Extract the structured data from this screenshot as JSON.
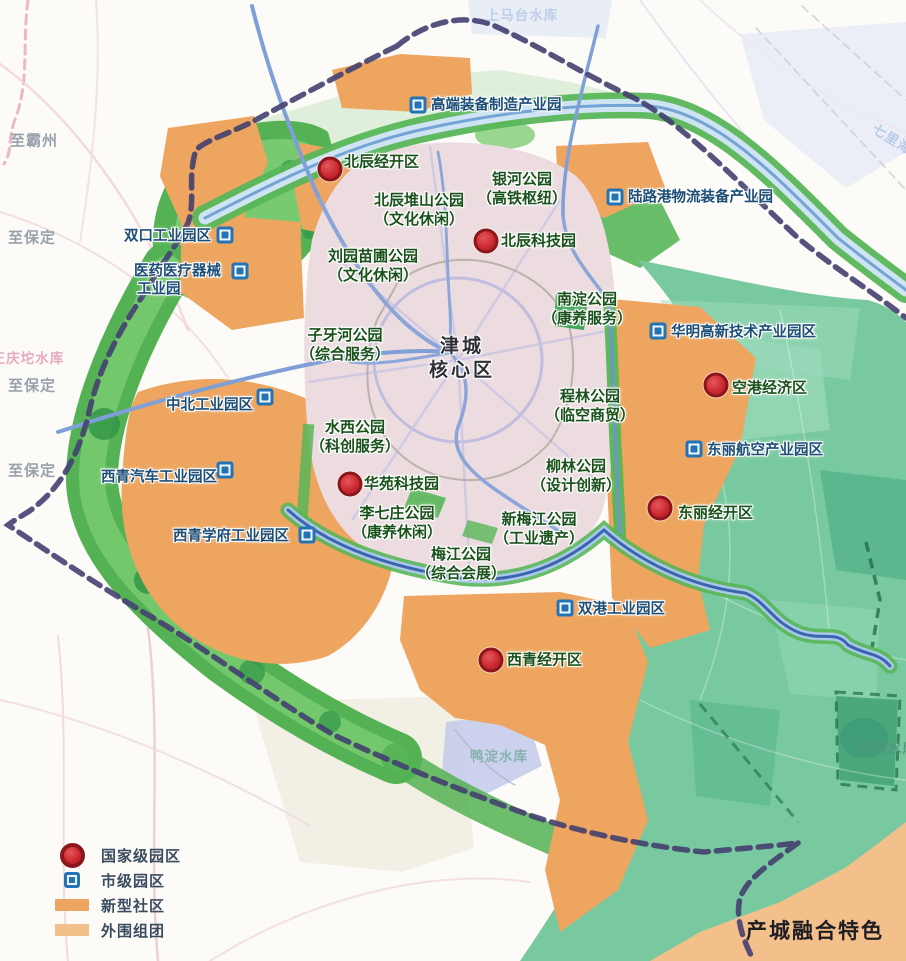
{
  "core_label": {
    "line1": "津城",
    "line2": "核心区",
    "x": 462,
    "y": 359
  },
  "corner_note": {
    "text": "产城融合特色",
    "x": 815,
    "y": 930
  },
  "direction_labels": [
    {
      "text": "至霸州",
      "x": 10,
      "y": 140
    },
    {
      "text": "至保定",
      "x": 8,
      "y": 237
    },
    {
      "text": "至保定",
      "x": 8,
      "y": 385
    },
    {
      "text": "至保定",
      "x": 8,
      "y": 470
    }
  ],
  "water_labels": [
    {
      "text": "上马台水库",
      "x": 522,
      "y": 14,
      "color": "#b9cbe8",
      "rotate": 0
    },
    {
      "text": "七里海",
      "x": 893,
      "y": 138,
      "color": "#b3c8e8",
      "rotate": 32
    },
    {
      "text": "王庆坨水库",
      "x": 28,
      "y": 357,
      "color": "#e4a2b8",
      "rotate": 0
    },
    {
      "text": "鸭淀水库",
      "x": 499,
      "y": 755,
      "color": "#7fb0a8",
      "rotate": 0
    },
    {
      "text": "官港水库",
      "x": 888,
      "y": 747,
      "color": "#4f9880",
      "rotate": 0
    }
  ],
  "park_labels": [
    {
      "line1": "北辰堆山公园",
      "line2": "（文化休闲）",
      "x": 419,
      "y": 211
    },
    {
      "line1": "银河公园",
      "line2": "（高铁枢纽）",
      "x": 522,
      "y": 190
    },
    {
      "line1": "刘园苗圃公园",
      "line2": "（文化休闲）",
      "x": 373,
      "y": 267
    },
    {
      "line1": "南淀公园",
      "line2": "（康养服务）",
      "x": 587,
      "y": 310
    },
    {
      "line1": "子牙河公园",
      "line2": "（综合服务）",
      "x": 345,
      "y": 346
    },
    {
      "line1": "水西公园",
      "line2": "（科创服务）",
      "x": 355,
      "y": 438
    },
    {
      "line1": "程林公园",
      "line2": "（临空商贸）",
      "x": 590,
      "y": 407
    },
    {
      "line1": "柳林公园",
      "line2": "（设计创新）",
      "x": 576,
      "y": 477
    },
    {
      "line1": "李七庄公园",
      "line2": "（康养休闲）",
      "x": 397,
      "y": 524
    },
    {
      "line1": "新梅江公园",
      "line2": "（工业遗产）",
      "x": 539,
      "y": 530
    },
    {
      "line1": "梅江公园",
      "line2": "（综合会展）",
      "x": 461,
      "y": 565
    }
  ],
  "national_parks": [
    {
      "name": "北辰经开区",
      "cx": 330,
      "cy": 169,
      "tx": 344,
      "ty": 161
    },
    {
      "name": "北辰科技园",
      "cx": 486,
      "cy": 241,
      "tx": 501,
      "ty": 240
    },
    {
      "name": "空港经济区",
      "cx": 716,
      "cy": 385,
      "tx": 732,
      "ty": 387
    },
    {
      "name": "华苑科技园",
      "cx": 350,
      "cy": 484,
      "tx": 364,
      "ty": 483
    },
    {
      "name": "东丽经开区",
      "cx": 660,
      "cy": 508,
      "tx": 678,
      "ty": 512
    },
    {
      "name": "西青经开区",
      "cx": 491,
      "cy": 660,
      "tx": 507,
      "ty": 659
    }
  ],
  "city_parks": [
    {
      "name": "高端装备制造产业园",
      "ix": 418,
      "iy": 105,
      "tx": 431,
      "ty": 104
    },
    {
      "name": "陆路港物流装备产业园",
      "ix": 615,
      "iy": 197,
      "tx": 628,
      "ty": 196
    },
    {
      "name": "双口工业园区",
      "ix": 225,
      "iy": 235,
      "tx": 124,
      "ty": 235
    },
    {
      "name": "医药医疗器械",
      "name2": "工业园",
      "ix": 240,
      "iy": 271,
      "tx": 134,
      "ty": 270,
      "t2x": 137,
      "t2y": 288
    },
    {
      "name": "华明高新技术产业园区",
      "ix": 658,
      "iy": 331,
      "tx": 671,
      "ty": 331
    },
    {
      "name": "中北工业园区",
      "ix": 265,
      "iy": 397,
      "tx": 166,
      "ty": 404
    },
    {
      "name": "东丽航空产业园区",
      "ix": 694,
      "iy": 449,
      "tx": 707,
      "ty": 449
    },
    {
      "name": "西青汽车工业园区",
      "ix": 225,
      "iy": 470,
      "tx": 101,
      "ty": 476
    },
    {
      "name": "西青学府工业园区",
      "ix": 307,
      "iy": 535,
      "tx": 173,
      "ty": 535
    },
    {
      "name": "双港工业园区",
      "ix": 565,
      "iy": 608,
      "tx": 578,
      "ty": 608
    }
  ],
  "legend": {
    "items": [
      {
        "type": "national",
        "label": "国家级园区"
      },
      {
        "type": "city",
        "label": "市级园区"
      },
      {
        "type": "community",
        "label": "新型社区",
        "color": "#eda55f"
      },
      {
        "type": "periphery",
        "label": "外围组团",
        "color": "#f3c08c"
      }
    ]
  },
  "colors": {
    "national_marker": "#cb2b31",
    "city_marker": "#2474b5",
    "community_orange": "#eda55f",
    "periphery_orange": "#f3c08c",
    "park_text": "#1a521c",
    "industry_text": "#1c4e78"
  }
}
